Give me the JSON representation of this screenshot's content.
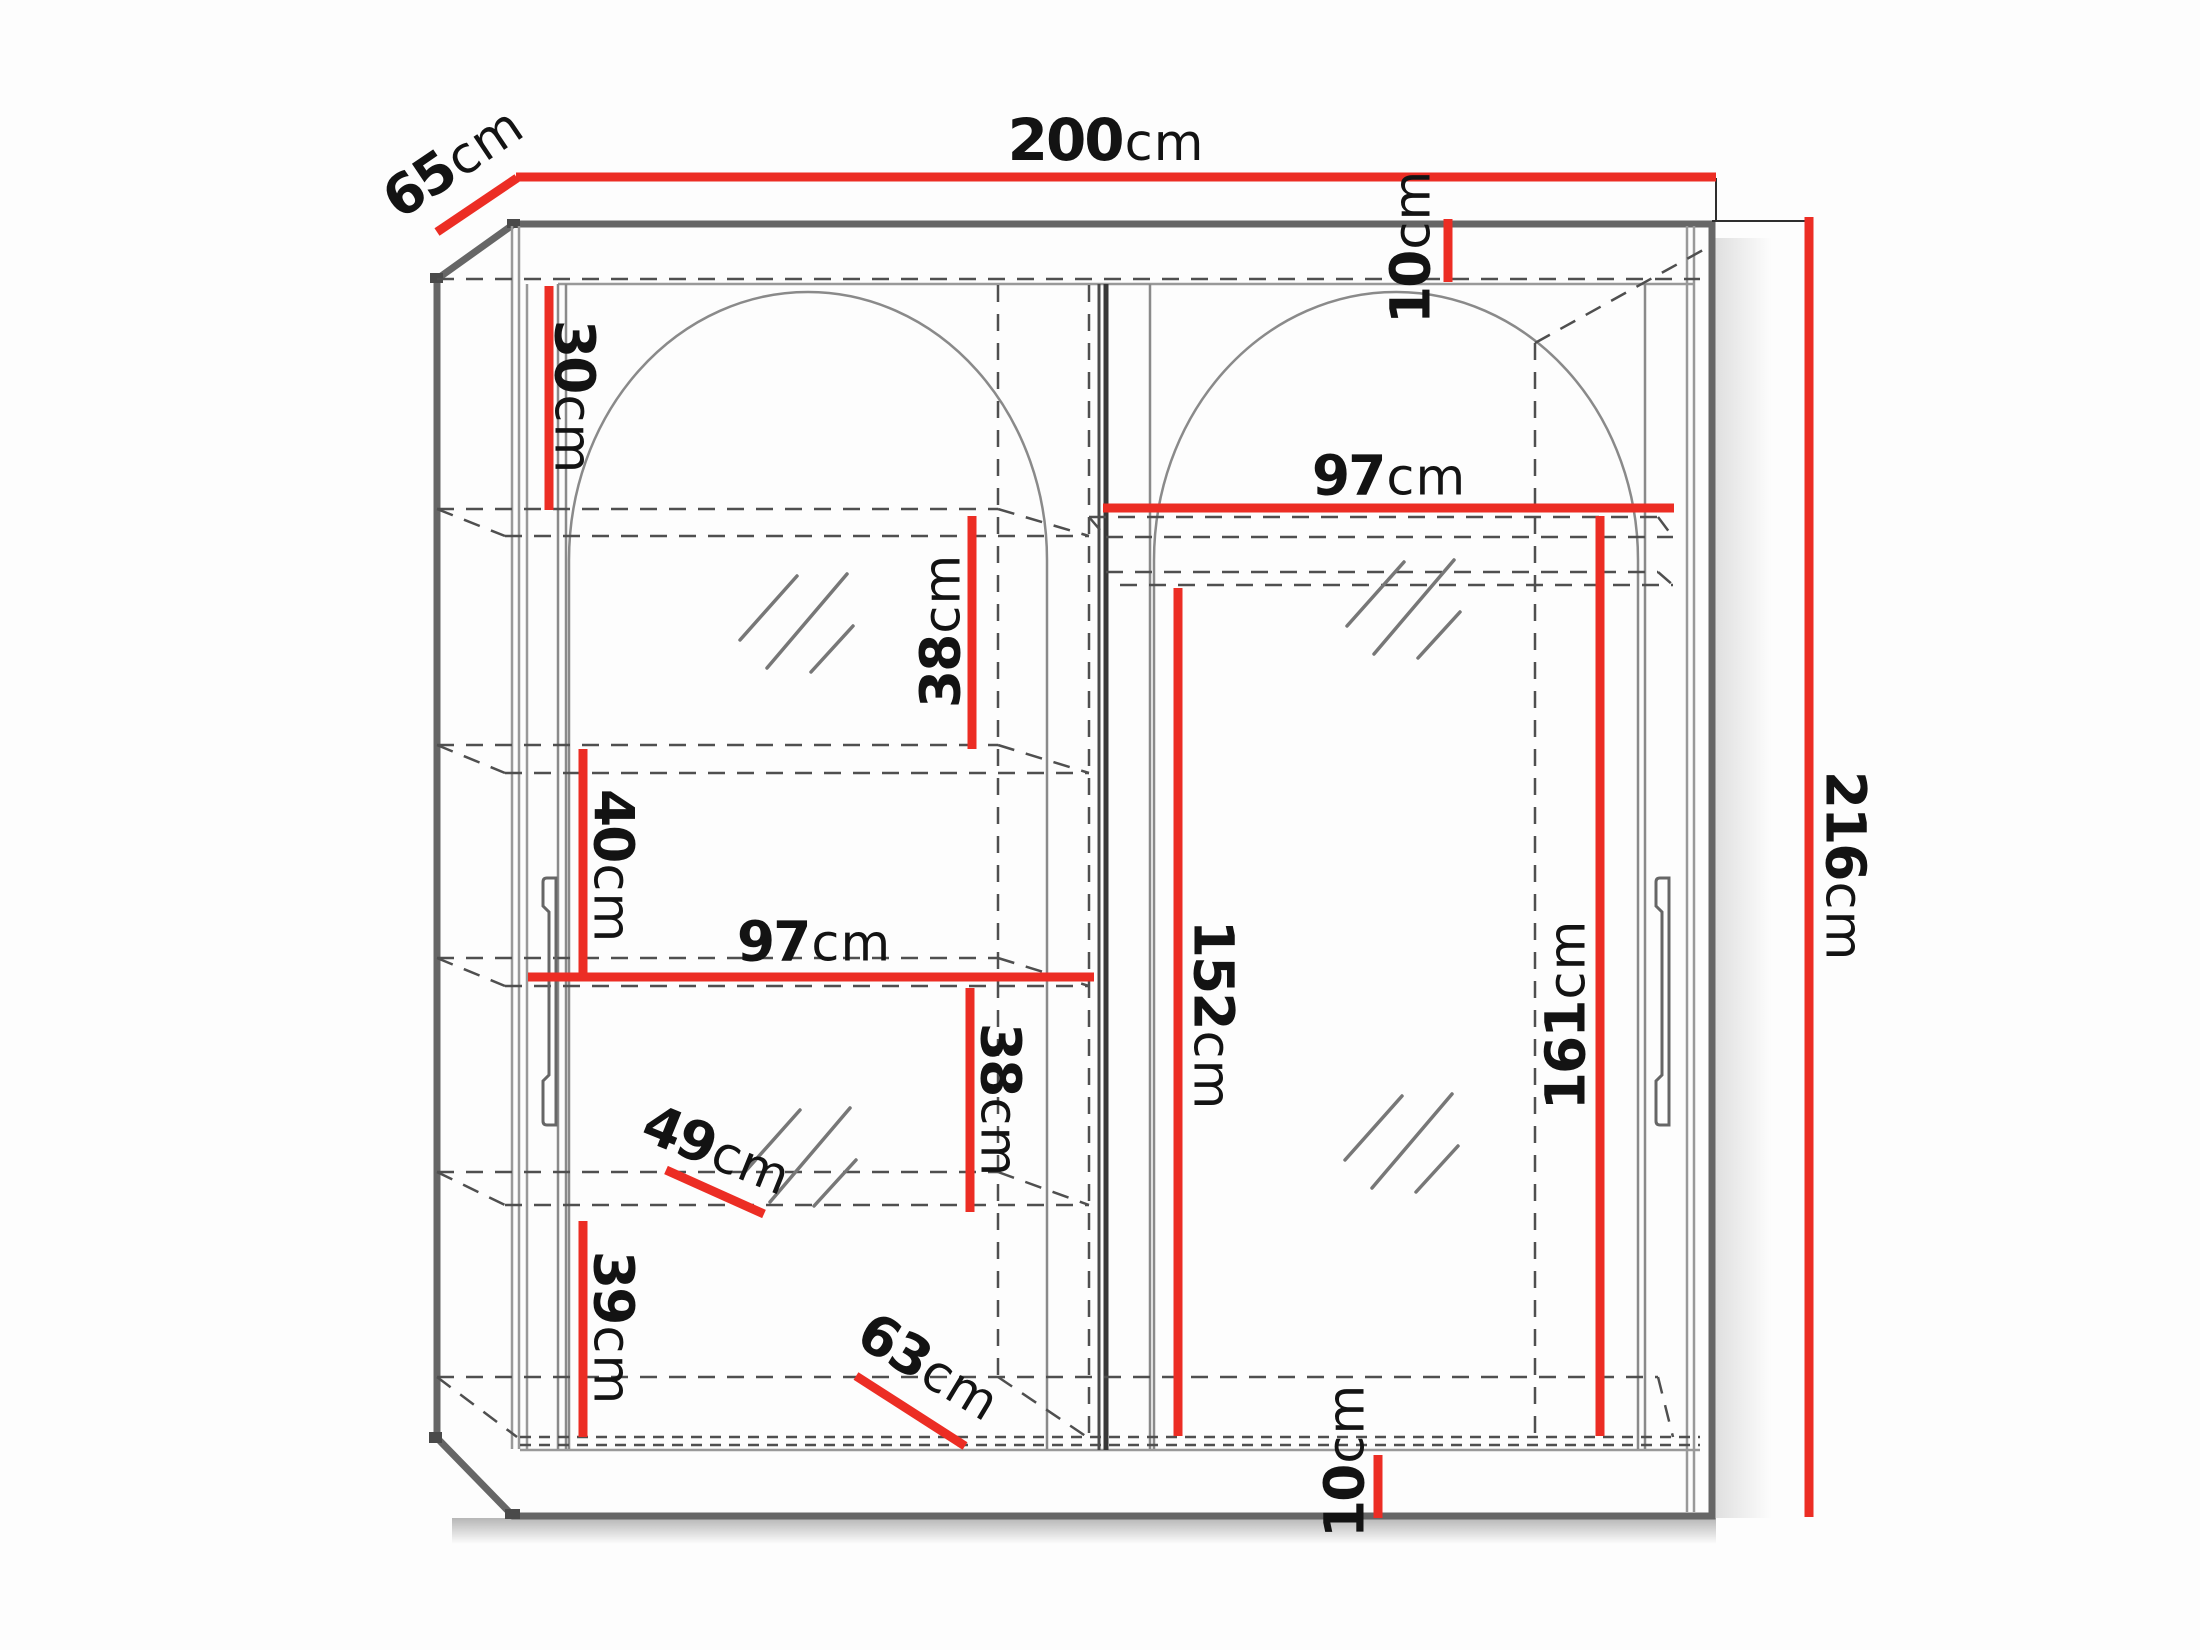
{
  "diagram": {
    "figure_type": "furniture dimension diagram",
    "subject": "two-door sliding wardrobe with arched mirror fronts, interior shelves and hanging rail",
    "unit": "cm",
    "colors": {
      "dimension_line_red": "#ec2d24",
      "outline_gray": "#666666",
      "hidden_dashed_gray": "#4f4f4f",
      "thin_panel_gray": "#999999",
      "label_text": "#131313",
      "background": "#fdfdfd"
    },
    "dimensions": {
      "overall_width": {
        "value": "200",
        "unit": "cm"
      },
      "overall_depth": {
        "value": "65",
        "unit": "cm"
      },
      "overall_height": {
        "value": "216",
        "unit": "cm"
      },
      "top_panel_offset": {
        "value": "10",
        "unit": "cm"
      },
      "left_gap_top_shelf": {
        "value": "30",
        "unit": "cm"
      },
      "left_shelf_gap_upper": {
        "value": "38",
        "unit": "cm"
      },
      "left_shelf_gap_middle": {
        "value": "40",
        "unit": "cm"
      },
      "left_section_width": {
        "value": "97",
        "unit": "cm"
      },
      "left_shelf_gap_lower": {
        "value": "38",
        "unit": "cm"
      },
      "left_shelf_gap_bottom": {
        "value": "39",
        "unit": "cm"
      },
      "shelf_depth": {
        "value": "49",
        "unit": "cm"
      },
      "bottom_depth": {
        "value": "63",
        "unit": "cm"
      },
      "right_section_width": {
        "value": "97",
        "unit": "cm"
      },
      "hanging_clearance": {
        "value": "152",
        "unit": "cm"
      },
      "right_section_height": {
        "value": "161",
        "unit": "cm"
      },
      "base_height": {
        "value": "10",
        "unit": "cm"
      }
    }
  }
}
